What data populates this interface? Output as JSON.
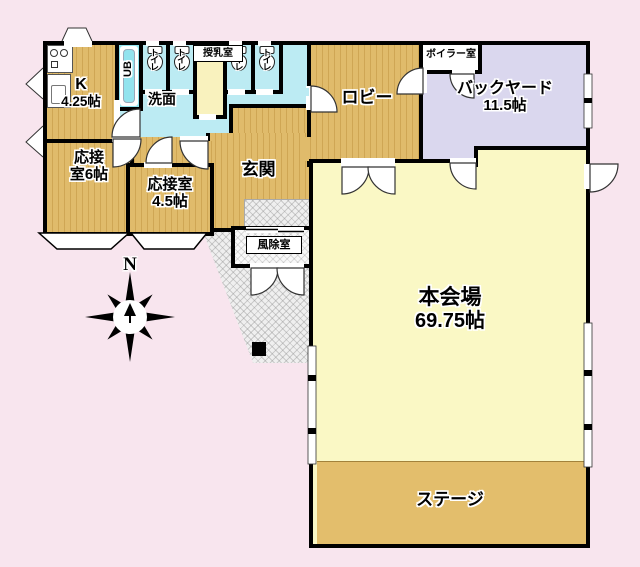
{
  "plan": {
    "compass_north": "N",
    "rooms": {
      "kitchen": {
        "line1": "K",
        "line2": "4.25帖"
      },
      "unit_bath": "UB",
      "toilet": "トイレ",
      "nursing_room": "授乳室",
      "washroom": "洗面",
      "lobby": "ロビー",
      "boiler_room": "ボイラー室",
      "backyard": {
        "line1": "バックヤード",
        "line2": "11.5帖"
      },
      "reception_6": {
        "line1": "応接",
        "line2": "室6帖"
      },
      "reception_45": {
        "line1": "応接室",
        "line2": "4.5帖"
      },
      "entrance": "玄関",
      "windbreak_room": "風除室",
      "main_hall": {
        "line1": "本会場",
        "line2": "69.75帖"
      },
      "stage": "ステージ"
    },
    "colors": {
      "background": "#F8E5EE",
      "wood_floor": "#E0BB6B",
      "main_hall": "#FAF8C5",
      "stage": "#E3BE6C",
      "backyard": "#DAD7EE",
      "wet_area": "#BCEBF3",
      "unit_bath": "#93E3EE",
      "nursing_room": "#F9F2BE",
      "wall": "#000000"
    }
  }
}
